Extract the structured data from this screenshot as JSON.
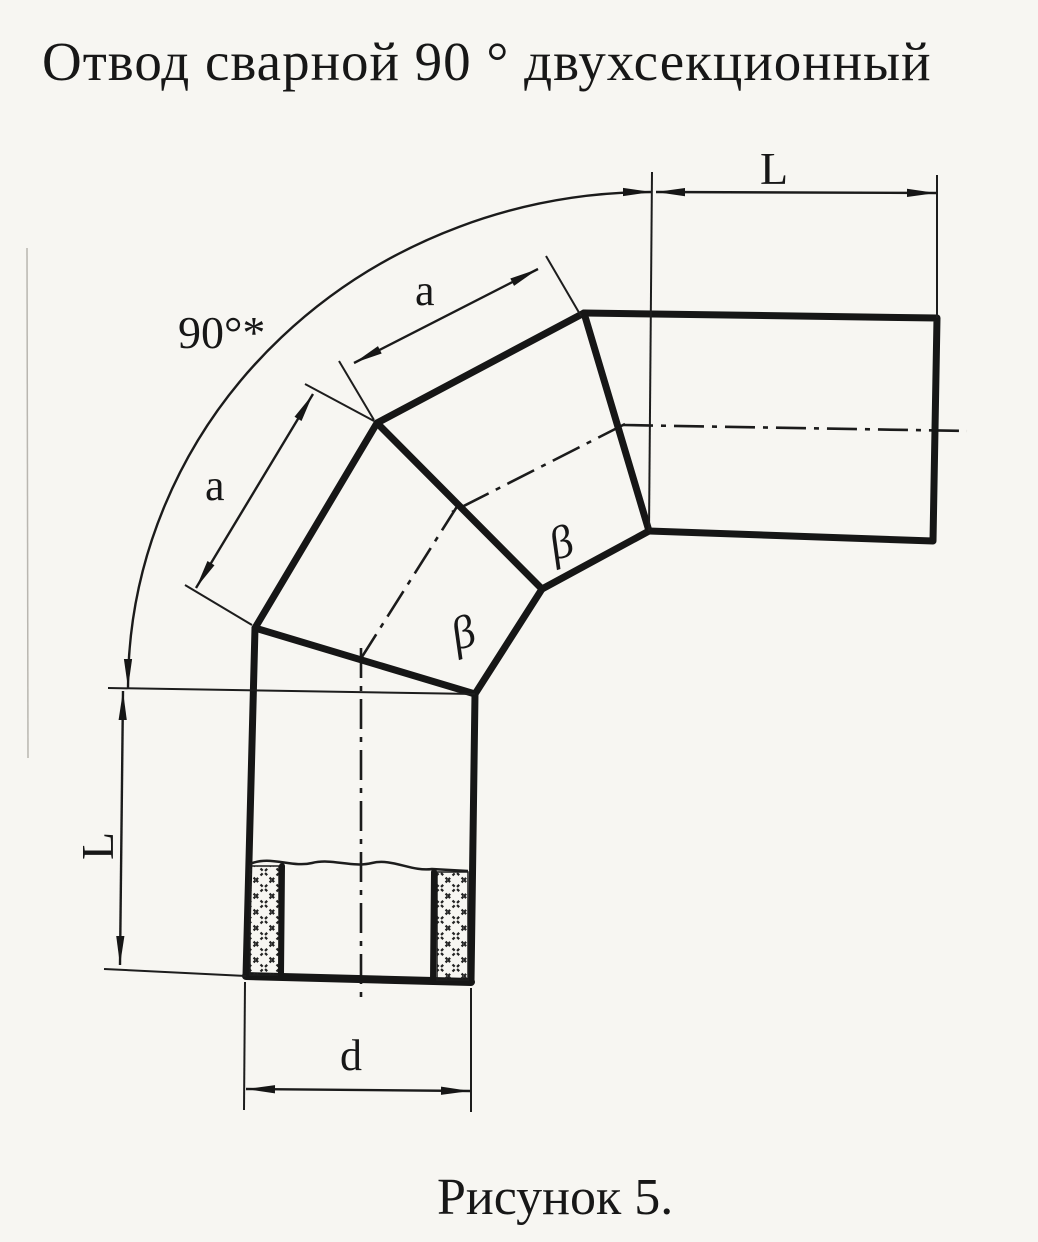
{
  "title": "Отвод сварной 90 ° двухсекционный",
  "caption": "Рисунок 5.",
  "labels": {
    "angle": "90°*",
    "dim_L_top": "L",
    "dim_L_left": "L",
    "dim_a_top": "a",
    "dim_a_left": "a",
    "dim_d": "d",
    "beta_seam_1": "β",
    "beta_seam_2": "β"
  },
  "colors": {
    "ink": "#161616",
    "paper": "#f7f6f2"
  }
}
